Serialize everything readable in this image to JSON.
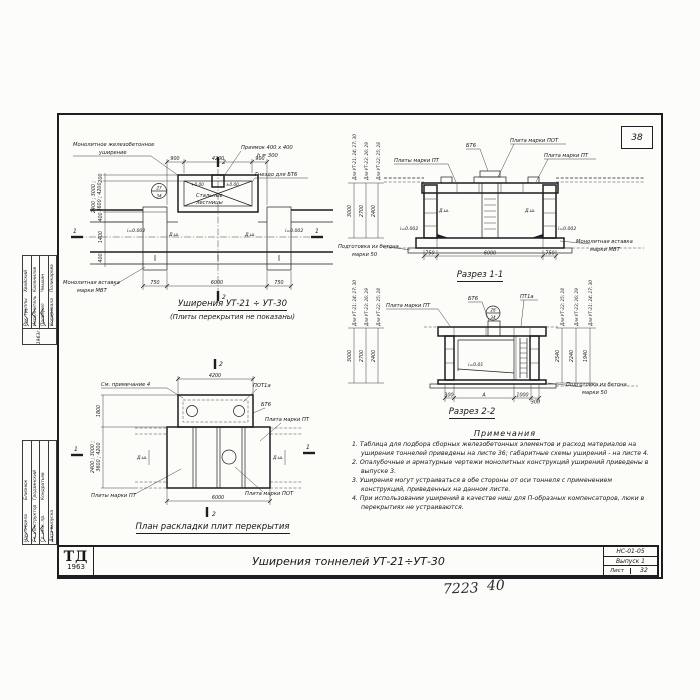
{
  "frame": {
    "sheet_corner_number": "38"
  },
  "stamp": {
    "logo_name": "ТД",
    "logo_year": "1963",
    "title": "Уширения тоннелей УТ-21÷УТ-30",
    "doc_code": "НС-01-05",
    "issue": "Выпуск 1",
    "sheet_word": "Лист",
    "sheet_number": "32"
  },
  "handwritten": {
    "order_number": "7223",
    "page_number": "40"
  },
  "plan_top": {
    "title": "Уширения УТ-21 ÷ УТ-30",
    "subtitle": "(Плиты перекрытия не показаны)",
    "label_widening_1": "Монолитное железобетонное",
    "label_widening_2": "уширение",
    "label_pit_1": "Приямок 400 x 400",
    "label_pit_2": "h = 300",
    "label_socket": "Гнездо для БТ6",
    "label_stairs_1": "Стальные",
    "label_stairs_2": "лестницы",
    "label_insert_1": "Монолитная вставка",
    "label_insert_2": "марки МВТ",
    "detail_circle_top": "27",
    "detail_circle_bottom": "34",
    "elev_left": "+0.00",
    "elev_right": "±0.00",
    "dims_top": [
      "900",
      "4200",
      "900"
    ],
    "dims_bottom": [
      "750",
      "6000",
      "750"
    ],
    "dims_left": [
      "200",
      "400",
      "1400",
      "400"
    ],
    "dims_left_var_1": "2400 ; 3000 ;",
    "dims_left_var_2": "3600 ; 4200",
    "slope_left": "i=0.002",
    "slope_right": "i=0.002",
    "dsh": "Д.ш.",
    "section_mark_1": "1",
    "section_mark_2": "2"
  },
  "section_1_1": {
    "title": "Разрез 1-1",
    "label_bt6": "БТ6",
    "label_plate_pot": "Плита марки ПОТ",
    "label_plates_pt": "Плиты марки ПТ",
    "label_plate_pt": "Плита марки ПТ",
    "label_base_1": "Подготовка из бетона",
    "label_base_2": "марки 50",
    "label_insert_1": "Монолитная вставка",
    "label_insert_2": "марки МВТ",
    "dims_bottom": [
      "750",
      "6000",
      "750"
    ],
    "slope_left": "i=0.002",
    "slope_right": "i=0.002",
    "dsh": "Д.ш.",
    "rot_dims": [
      {
        "label": "Для УТ-21; 24; 27; 30",
        "value": "3000"
      },
      {
        "label": "Для УТ-23; 26; 29",
        "value": "2700"
      },
      {
        "label": "Для УТ-22; 25; 28",
        "value": "2400"
      }
    ]
  },
  "section_2_2": {
    "title": "Разрез 2-2",
    "label_plate_pt": "Плита марки ПТ",
    "label_bt6": "БТ6",
    "label_pt1a": "ПТ1а",
    "detail_circle_top": "28",
    "detail_circle_bottom": "34",
    "slope": "i=0.01",
    "label_base_1": "Подготовка из бетона",
    "label_base_2": "марки 50",
    "dims_bottom": [
      "300",
      "А",
      "1000",
      "300"
    ],
    "rot_dims_left": [
      {
        "label": "Для УТ-21; 24; 27; 30",
        "value": "3000"
      },
      {
        "label": "Для УТ-23; 26; 29",
        "value": "2700"
      },
      {
        "label": "Для УТ-22; 25; 28",
        "value": "2400"
      }
    ],
    "rot_dims_right": [
      {
        "label": "Для УТ-22; 25; 28",
        "value": "2540"
      },
      {
        "label": "Для УТ-23; 26; 29",
        "value": "2240"
      },
      {
        "label": "Для УТ-21; 24; 27; 30",
        "value": "1940"
      }
    ]
  },
  "plan_plates": {
    "title": "План раскладки плит перекрытия",
    "label_see_note": "См. примечание 4",
    "label_pot1a": "ПОТ1а",
    "label_bt6": "БТ6",
    "label_plate_pt": "Плита марки ПТ",
    "label_plates_pt": "Плиты марки ПТ",
    "label_plate_pot": "Плита марки ПОТ",
    "dsh": "Д.ш.",
    "dim_top": "4200",
    "dim_bottom": "6000",
    "dim_left_upper": "1800",
    "dims_left_var_1": "2400 ; 3000 ;",
    "dims_left_var_2": "3600 ; 4200",
    "section_mark_1": "1",
    "section_mark_2": "2"
  },
  "notes": {
    "title": "Примечания",
    "items": [
      "1. Таблица для подбора сборных железобетонных элементов и расход материалов на уширения тоннелей приведены на листе 36; габаритные схемы уширений - на листе 4.",
      "2. Опалубочные и арматурные чертежи монолитных конструкций уширений приведены в выпуске 3.",
      "3. Уширения могут устраиваться в обе стороны от оси тоннеля с применением конструкций, приведенных на данном листе.",
      "4. При использовании уширений в качестве ниш для П-образных компенсаторов, люки в перекрытиях не устраиваются."
    ]
  },
  "signatures": {
    "group_a": {
      "year": "1963г.",
      "rows": [
        {
          "role": "Рук. группы",
          "name": "Хвойский"
        },
        {
          "role": "Исполнитель",
          "name": "Каленилов"
        },
        {
          "role": "Проверил",
          "name": "Чмыхин"
        },
        {
          "role": "Копировала",
          "name": "Поликарова"
        }
      ]
    },
    "group_b": {
      "rows": [
        {
          "role": "Нач. отдела",
          "name": "Близнюк"
        },
        {
          "role": "Гл. конструктор",
          "name": "Гродзинский"
        },
        {
          "role": "Гл. инж. пр.",
          "name": "Кондратьев"
        },
        {
          "role": "Дата выпуска",
          "name": ""
        }
      ]
    }
  }
}
